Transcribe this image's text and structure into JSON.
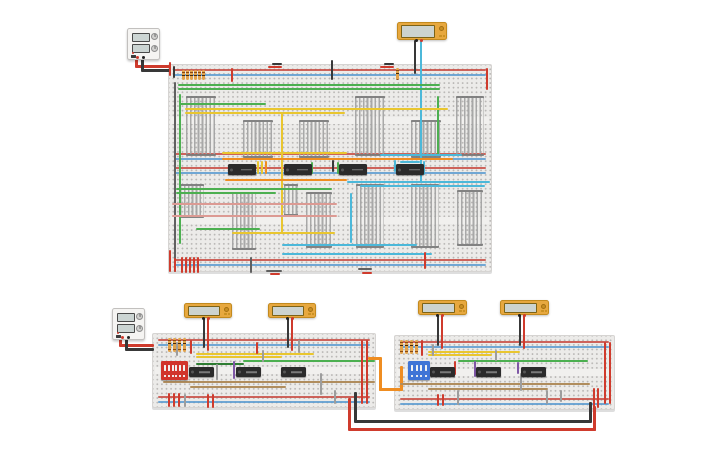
{
  "canvas": {
    "width": 725,
    "height": 453,
    "background": "#ffffff"
  },
  "colors": {
    "r": "#cf3b2d",
    "k": "#383838",
    "dk": "#606060",
    "g": "#4caf50",
    "dg": "#2e7d32",
    "y": "#e9c62f",
    "o": "#ef8d21",
    "c": "#4cb8d9",
    "t": "#b08d5d",
    "p": "#7e57a5",
    "gy": "#9d9d9d",
    "pk": "#dc9a93",
    "railRed": "#c84b42",
    "railBlue": "#5b9bd0",
    "icBody": "#2b2b2b",
    "meterBody": "#e7a83f",
    "dipRed": "#d1342b",
    "dipBlue": "#3f74d6"
  },
  "color_names": {
    "r": "red",
    "k": "black",
    "dk": "dark-gray",
    "g": "green",
    "dg": "dark-green",
    "y": "yellow",
    "o": "orange",
    "c": "cyan",
    "t": "tan",
    "p": "purple",
    "gy": "gray",
    "pk": "pink"
  },
  "breadboards": [
    {
      "id": "breadboard-large",
      "x": 168,
      "y": 64,
      "w": 324,
      "h": 208,
      "rails": [
        4,
        88,
        102,
        194
      ],
      "gaps": [
        52,
        152
      ]
    },
    {
      "id": "breadboard-bottom-left",
      "x": 152,
      "y": 333,
      "w": 224,
      "h": 75,
      "rails": [
        5,
        62
      ],
      "gaps": [
        33
      ]
    },
    {
      "id": "breadboard-bottom-right",
      "x": 394,
      "y": 335,
      "w": 221,
      "h": 75,
      "rails": [
        5,
        62
      ],
      "gaps": [
        33
      ]
    }
  ],
  "power_supplies": [
    {
      "id": "power-supply-top",
      "x": 127,
      "y": 28,
      "w": 33,
      "h": 32
    },
    {
      "id": "power-supply-bottom",
      "x": 112,
      "y": 308,
      "w": 33,
      "h": 32
    }
  ],
  "multimeters": [
    {
      "id": "multimeter-top",
      "x": 397,
      "y": 22,
      "w": 50,
      "h": 18
    },
    {
      "id": "multimeter-1",
      "x": 184,
      "y": 303,
      "w": 48,
      "h": 15
    },
    {
      "id": "multimeter-2",
      "x": 268,
      "y": 303,
      "w": 48,
      "h": 15
    },
    {
      "id": "multimeter-3",
      "x": 418,
      "y": 300,
      "w": 49,
      "h": 15
    },
    {
      "id": "multimeter-4",
      "x": 500,
      "y": 300,
      "w": 49,
      "h": 15
    }
  ],
  "ics": [
    {
      "x": 228,
      "y": 164,
      "w": 28,
      "h": 11,
      "label": ""
    },
    {
      "x": 284,
      "y": 164,
      "w": 28,
      "h": 11,
      "label": ""
    },
    {
      "x": 339,
      "y": 164,
      "w": 28,
      "h": 11,
      "label": ""
    },
    {
      "x": 396,
      "y": 164,
      "w": 28,
      "h": 11,
      "label": ""
    },
    {
      "x": 189,
      "y": 367,
      "w": 25,
      "h": 10,
      "label": ""
    },
    {
      "x": 236,
      "y": 367,
      "w": 25,
      "h": 10,
      "label": ""
    },
    {
      "x": 281,
      "y": 367,
      "w": 25,
      "h": 10,
      "label": ""
    },
    {
      "x": 430,
      "y": 367,
      "w": 25,
      "h": 10,
      "label": ""
    },
    {
      "x": 476,
      "y": 367,
      "w": 25,
      "h": 10,
      "label": ""
    },
    {
      "x": 521,
      "y": 367,
      "w": 25,
      "h": 10,
      "label": ""
    }
  ],
  "dip_switches": [
    {
      "id": "dip-switch-red",
      "x": 161,
      "y": 361,
      "w": 27,
      "h": 19,
      "color": "#d1342b",
      "toggles": 6
    },
    {
      "id": "dip-switch-blue",
      "x": 408,
      "y": 361,
      "w": 22,
      "h": 19,
      "color": "#3f74d6",
      "toggles": 4
    }
  ],
  "resistors": [
    [
      182,
      70,
      10
    ],
    [
      186,
      70,
      10
    ],
    [
      190,
      70,
      10
    ],
    [
      194,
      70,
      10
    ],
    [
      198,
      70,
      10
    ],
    [
      202,
      70,
      10
    ],
    [
      396,
      68,
      12
    ],
    [
      168,
      338,
      14
    ],
    [
      173,
      338,
      14
    ],
    [
      178,
      338,
      14
    ],
    [
      183,
      338,
      14
    ],
    [
      400,
      340,
      14
    ],
    [
      405,
      340,
      14
    ],
    [
      410,
      340,
      14
    ],
    [
      415,
      340,
      14
    ]
  ],
  "bundles": [
    [
      186,
      96,
      30,
      60
    ],
    [
      243,
      120,
      30,
      38
    ],
    [
      299,
      120,
      30,
      38
    ],
    [
      355,
      96,
      30,
      60
    ],
    [
      411,
      120,
      30,
      38
    ],
    [
      456,
      96,
      28,
      60
    ],
    [
      180,
      184,
      24,
      34
    ],
    [
      232,
      192,
      24,
      58
    ],
    [
      284,
      184,
      14,
      32
    ],
    [
      306,
      192,
      26,
      56
    ],
    [
      356,
      184,
      28,
      64
    ],
    [
      411,
      184,
      28,
      64
    ],
    [
      457,
      190,
      26,
      56
    ]
  ],
  "wires": [
    [
      135,
      57,
      3,
      10,
      "r"
    ],
    [
      135,
      65,
      36,
      3,
      "r"
    ],
    [
      141,
      57,
      3,
      14,
      "k"
    ],
    [
      141,
      69,
      30,
      3,
      "k"
    ],
    [
      119,
      339,
      3,
      7,
      "r"
    ],
    [
      119,
      344,
      35,
      3,
      "r"
    ],
    [
      125,
      339,
      3,
      11,
      "k"
    ],
    [
      125,
      348,
      29,
      3,
      "k"
    ],
    [
      414,
      40,
      2,
      34,
      "k"
    ],
    [
      420,
      40,
      2,
      143,
      "c"
    ],
    [
      203,
      318,
      2,
      30,
      "k"
    ],
    [
      207,
      318,
      2,
      33,
      "r"
    ],
    [
      287,
      318,
      2,
      30,
      "k"
    ],
    [
      291,
      318,
      2,
      33,
      "r"
    ],
    [
      437,
      315,
      2,
      31,
      "k"
    ],
    [
      441,
      315,
      2,
      34,
      "r"
    ],
    [
      519,
      315,
      2,
      31,
      "k"
    ],
    [
      523,
      315,
      2,
      34,
      "r"
    ],
    [
      368,
      357,
      13,
      3,
      "o"
    ],
    [
      379,
      357,
      3,
      34,
      "o"
    ],
    [
      379,
      388,
      24,
      3,
      "o"
    ],
    [
      400,
      366,
      3,
      25,
      "o"
    ],
    [
      348,
      398,
      3,
      32,
      "r"
    ],
    [
      348,
      428,
      248,
      3,
      "r"
    ],
    [
      593,
      406,
      3,
      25,
      "r"
    ],
    [
      354,
      392,
      3,
      30,
      "k"
    ],
    [
      354,
      420,
      238,
      3,
      "k"
    ],
    [
      589,
      402,
      3,
      20,
      "k"
    ],
    [
      169,
      62,
      2,
      14,
      "r"
    ],
    [
      173,
      66,
      2,
      12,
      "k"
    ],
    [
      231,
      68,
      2,
      14,
      "r"
    ],
    [
      331,
      60,
      2,
      20,
      "k"
    ],
    [
      268,
      66,
      14,
      2,
      "r"
    ],
    [
      272,
      63,
      10,
      2,
      "k"
    ],
    [
      380,
      66,
      14,
      2,
      "r"
    ],
    [
      384,
      63,
      10,
      2,
      "k"
    ],
    [
      486,
      68,
      2,
      22,
      "r"
    ],
    [
      178,
      84,
      262,
      2,
      "g"
    ],
    [
      178,
      88,
      262,
      2,
      "g"
    ],
    [
      180,
      103,
      86,
      2,
      "g"
    ],
    [
      179,
      94,
      2,
      150,
      "g"
    ],
    [
      437,
      96,
      2,
      60,
      "g"
    ],
    [
      185,
      108,
      263,
      2,
      "y"
    ],
    [
      185,
      112,
      160,
      2,
      "y"
    ],
    [
      281,
      112,
      2,
      122,
      "y"
    ],
    [
      222,
      152,
      125,
      2,
      "y"
    ],
    [
      380,
      154,
      82,
      2,
      "c"
    ],
    [
      222,
      158,
      231,
      2,
      "o"
    ],
    [
      225,
      179,
      122,
      2,
      "o"
    ],
    [
      347,
      181,
      143,
      2,
      "c"
    ],
    [
      360,
      185,
      125,
      2,
      "c"
    ],
    [
      257,
      161,
      2,
      13,
      "y"
    ],
    [
      261,
      161,
      2,
      13,
      "y"
    ],
    [
      265,
      161,
      2,
      13,
      "o"
    ],
    [
      311,
      162,
      2,
      12,
      "g"
    ],
    [
      337,
      162,
      2,
      12,
      "g"
    ],
    [
      394,
      160,
      2,
      12,
      "c"
    ],
    [
      400,
      161,
      20,
      2,
      "c"
    ],
    [
      423,
      161,
      2,
      14,
      "c"
    ],
    [
      332,
      160,
      2,
      12,
      "k"
    ],
    [
      174,
      82,
      2,
      190,
      "dk"
    ],
    [
      172,
      203,
      165,
      2,
      "pk"
    ],
    [
      172,
      215,
      165,
      2,
      "pk"
    ],
    [
      176,
      188,
      156,
      2,
      "g"
    ],
    [
      176,
      192,
      100,
      2,
      "g"
    ],
    [
      196,
      228,
      64,
      2,
      "g"
    ],
    [
      232,
      232,
      103,
      2,
      "y"
    ],
    [
      282,
      244,
      135,
      2,
      "c"
    ],
    [
      282,
      253,
      150,
      2,
      "c"
    ],
    [
      350,
      193,
      2,
      50,
      "c"
    ],
    [
      181,
      257,
      2,
      16,
      "r"
    ],
    [
      185,
      257,
      2,
      16,
      "r"
    ],
    [
      189,
      257,
      2,
      16,
      "r"
    ],
    [
      193,
      257,
      2,
      16,
      "r"
    ],
    [
      197,
      257,
      2,
      16,
      "r"
    ],
    [
      169,
      250,
      2,
      22,
      "r"
    ],
    [
      174,
      258,
      2,
      14,
      "r"
    ],
    [
      250,
      257,
      2,
      16,
      "dk"
    ],
    [
      266,
      270,
      16,
      2,
      "dk"
    ],
    [
      270,
      273,
      10,
      2,
      "r"
    ],
    [
      424,
      252,
      2,
      17,
      "r"
    ],
    [
      358,
      268,
      14,
      2,
      "dk"
    ],
    [
      362,
      272,
      10,
      2,
      "r"
    ],
    [
      196,
      353,
      118,
      2,
      "y"
    ],
    [
      196,
      356,
      86,
      2,
      "y"
    ],
    [
      243,
      360,
      132,
      2,
      "g"
    ],
    [
      196,
      363,
      48,
      2,
      "dg"
    ],
    [
      163,
      381,
      212,
      2,
      "t"
    ],
    [
      190,
      386,
      96,
      2,
      "t"
    ],
    [
      233,
      361,
      2,
      18,
      "p"
    ],
    [
      176,
      342,
      2,
      14,
      "gy"
    ],
    [
      216,
      364,
      2,
      16,
      "gy"
    ],
    [
      298,
      340,
      2,
      13,
      "gy"
    ],
    [
      320,
      373,
      2,
      22,
      "gy"
    ],
    [
      184,
      394,
      2,
      13,
      "gy"
    ],
    [
      262,
      350,
      2,
      12,
      "gy"
    ],
    [
      334,
      390,
      2,
      14,
      "gy"
    ],
    [
      190,
      340,
      2,
      14,
      "r"
    ],
    [
      256,
      342,
      2,
      12,
      "r"
    ],
    [
      207,
      394,
      2,
      14,
      "r"
    ],
    [
      212,
      394,
      2,
      14,
      "r"
    ],
    [
      168,
      393,
      2,
      14,
      "r"
    ],
    [
      173,
      393,
      2,
      14,
      "r"
    ],
    [
      178,
      393,
      2,
      14,
      "r"
    ],
    [
      361,
      340,
      2,
      64,
      "r"
    ],
    [
      366,
      340,
      2,
      64,
      "r"
    ],
    [
      428,
      351,
      92,
      2,
      "y"
    ],
    [
      428,
      354,
      64,
      2,
      "y"
    ],
    [
      458,
      360,
      130,
      2,
      "g"
    ],
    [
      400,
      383,
      190,
      2,
      "t"
    ],
    [
      428,
      388,
      120,
      2,
      "t"
    ],
    [
      474,
      361,
      2,
      16,
      "p"
    ],
    [
      517,
      362,
      2,
      12,
      "p"
    ],
    [
      432,
      344,
      2,
      12,
      "gy"
    ],
    [
      457,
      390,
      2,
      15,
      "gy"
    ],
    [
      520,
      373,
      2,
      18,
      "gy"
    ],
    [
      546,
      390,
      2,
      14,
      "gy"
    ],
    [
      495,
      350,
      2,
      11,
      "gy"
    ],
    [
      560,
      390,
      2,
      12,
      "gy"
    ],
    [
      421,
      340,
      2,
      16,
      "r"
    ],
    [
      454,
      361,
      2,
      14,
      "r"
    ],
    [
      437,
      394,
      2,
      12,
      "r"
    ],
    [
      442,
      394,
      2,
      12,
      "r"
    ],
    [
      593,
      388,
      2,
      20,
      "r"
    ],
    [
      597,
      388,
      2,
      20,
      "r"
    ],
    [
      604,
      342,
      2,
      62,
      "r"
    ],
    [
      609,
      342,
      2,
      62,
      "r"
    ]
  ]
}
